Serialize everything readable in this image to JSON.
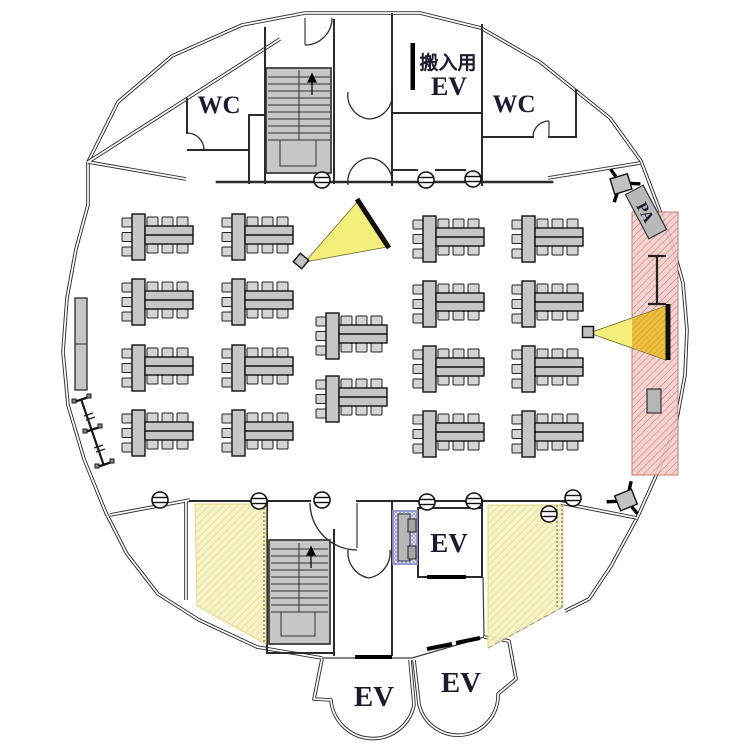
{
  "plan": {
    "type": "banquet-hall-floor-plan",
    "labels": {
      "wc_left": "WC",
      "wc_right": "WC",
      "service_ev_line1": "搬入用",
      "service_ev_line2": "EV",
      "ev_core": "EV",
      "ev_lobby_left": "EV",
      "ev_lobby_right": "EV",
      "pa": "PA"
    },
    "colors": {
      "wall": "#2b2b2b",
      "furniture_gray": "#c6c6c6",
      "chair_gray": "#d4d4d4",
      "beam_yellow": "#f4ee7c",
      "beam_orange": "#ecbf3e",
      "beam_orange_line": "#c9971f",
      "zone_yellow_base": "#f7f2c4",
      "zone_yellow_line": "#e2d47a",
      "zone_red_base": "#f2cfcc",
      "zone_red_line": "#c96a66",
      "zone_purple_line": "#8f8fc8",
      "screen_black": "#111111"
    },
    "tables": {
      "count": 18,
      "seats_per_table": 9,
      "positions": [
        [
          122,
          214
        ],
        [
          222,
          214
        ],
        [
          413,
          216
        ],
        [
          512,
          216
        ],
        [
          122,
          279
        ],
        [
          222,
          279
        ],
        [
          413,
          281
        ],
        [
          512,
          281
        ],
        [
          122,
          345
        ],
        [
          222,
          345
        ],
        [
          413,
          346
        ],
        [
          512,
          346
        ],
        [
          122,
          410
        ],
        [
          222,
          410
        ],
        [
          413,
          411
        ],
        [
          512,
          411
        ],
        [
          316,
          313
        ],
        [
          316,
          376
        ]
      ]
    },
    "zones": [
      {
        "name": "pa-zone-red",
        "kind": "red",
        "points": [
          [
            632,
            212
          ],
          [
            678,
            212
          ],
          [
            678,
            475
          ],
          [
            632,
            475
          ]
        ]
      },
      {
        "name": "storage-zone-yellow-left",
        "kind": "yellow",
        "points": [
          [
            195,
            504
          ],
          [
            266,
            504
          ],
          [
            266,
            644
          ],
          [
            197,
            606
          ]
        ]
      },
      {
        "name": "storage-zone-yellow-right",
        "kind": "yellow",
        "points": [
          [
            488,
            505
          ],
          [
            563,
            505
          ],
          [
            563,
            607
          ],
          [
            488,
            648
          ]
        ]
      },
      {
        "name": "av-rack-zone-purple",
        "kind": "purple",
        "points": [
          [
            393,
            511
          ],
          [
            417,
            511
          ],
          [
            417,
            564
          ],
          [
            393,
            564
          ]
        ]
      }
    ],
    "projectors": [
      {
        "name": "projector-beam-left",
        "apex": [
          305,
          262
        ],
        "corner1": [
          358,
          201
        ],
        "corner2": [
          387,
          247
        ],
        "screen": [
          [
            357,
            199
          ],
          [
            389,
            248
          ]
        ],
        "box": [
          296,
          256
        ],
        "box_rot": 40
      },
      {
        "name": "projector-beam-right",
        "apex": [
          589,
          333
        ],
        "corner1": [
          666,
          306
        ],
        "corner2": [
          666,
          360
        ],
        "screen": [
          [
            668,
            304
          ],
          [
            668,
            360
          ]
        ],
        "box": [
          583,
          327
        ],
        "box_rot": 0
      }
    ],
    "speakers": [
      {
        "name": "pa-speaker-top",
        "cx": 621,
        "cy": 184,
        "rot": -35
      },
      {
        "name": "pa-speaker-bottom",
        "cx": 626,
        "cy": 500,
        "rot": 140
      }
    ],
    "door_closers": [
      [
        322,
        180
      ],
      [
        426,
        180
      ],
      [
        473,
        179
      ],
      [
        160,
        500
      ],
      [
        259,
        501
      ],
      [
        322,
        500
      ],
      [
        427,
        502
      ],
      [
        474,
        501
      ],
      [
        573,
        498
      ],
      [
        549,
        514
      ]
    ],
    "misc_fixtures": {
      "side_table_left": [
        75,
        298,
        12,
        92
      ],
      "coat_rack_line": [
        [
          81,
          399
        ],
        [
          104,
          466
        ]
      ],
      "ibeam_screen_symbol": {
        "x": 657,
        "y_top": 256,
        "y_bot": 304,
        "cap_half": 9
      },
      "pa_cabinet": [
        647,
        389,
        14,
        24
      ]
    }
  }
}
